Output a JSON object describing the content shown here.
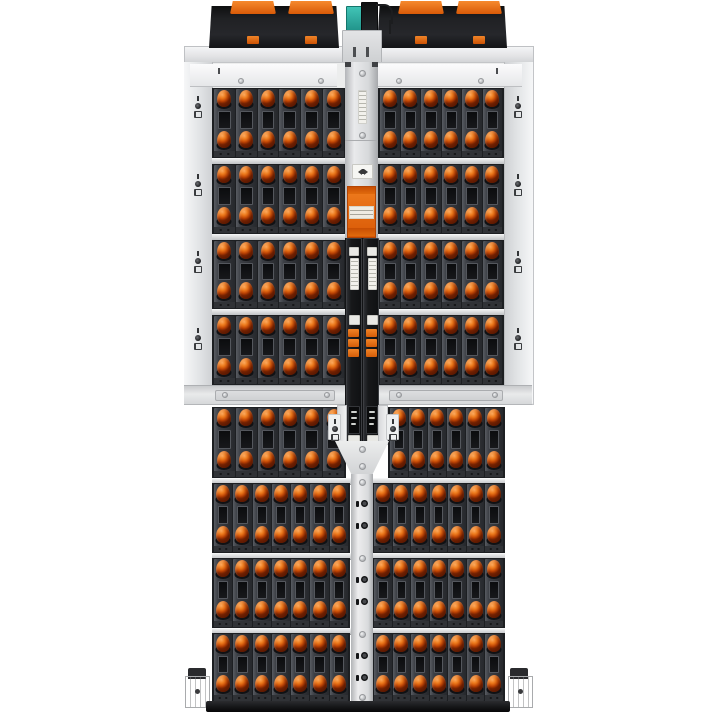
{
  "meta": {
    "description": "Top-down product photograph of a fully populated high-density storage enclosure (JBOD) with rows of hot-swap drive carriers with orange release latches",
    "width_px": 715,
    "height_px": 715,
    "background": "#ffffff"
  },
  "colors": {
    "latch_hi": "#fba95d",
    "latch_mid": "#ee7b1d",
    "latch_deep": "#c64704",
    "carrier": "#383b41",
    "carrier_dark": "#1d1f22",
    "window": "#101114",
    "frame_silver": "#eceded",
    "frame_dark": "#c3c5c8",
    "module_black": "#1a1b1e",
    "spine_orange": "#e56b10",
    "teal_connector": "#2fb0a4",
    "bottom_bar": "#1d1e20",
    "label_white": "#f2f1ea"
  },
  "drive_grid": {
    "top": {
      "row_blocks": 4,
      "cols_per_bank": 6,
      "banks_per_row": 2
    },
    "bottom": {
      "row_blocks": 4,
      "first_block_cols": 6,
      "cols_per_bank": 7,
      "banks_per_row": 2
    },
    "visible_drive_carriers": 102,
    "latches_per_carrier": 2
  },
  "top_assembly": {
    "fan_modules": 2,
    "orange_clips_per_module": 2,
    "orange_handles_per_module": 2,
    "center_connector": "teal",
    "cable": "black"
  },
  "center_spine": {
    "orange_handle_modules": 1,
    "black_canisters": 2,
    "orange_tabs_per_canister": 3,
    "white_labels": 4,
    "warning_labels": 1
  },
  "icons": [
    {
      "name": "row-lock-indicator-icon",
      "count": 8
    },
    {
      "name": "spine-latch-indicator-icon",
      "count": 6
    },
    {
      "name": "warning-arrows-icon",
      "count": 1
    }
  ]
}
